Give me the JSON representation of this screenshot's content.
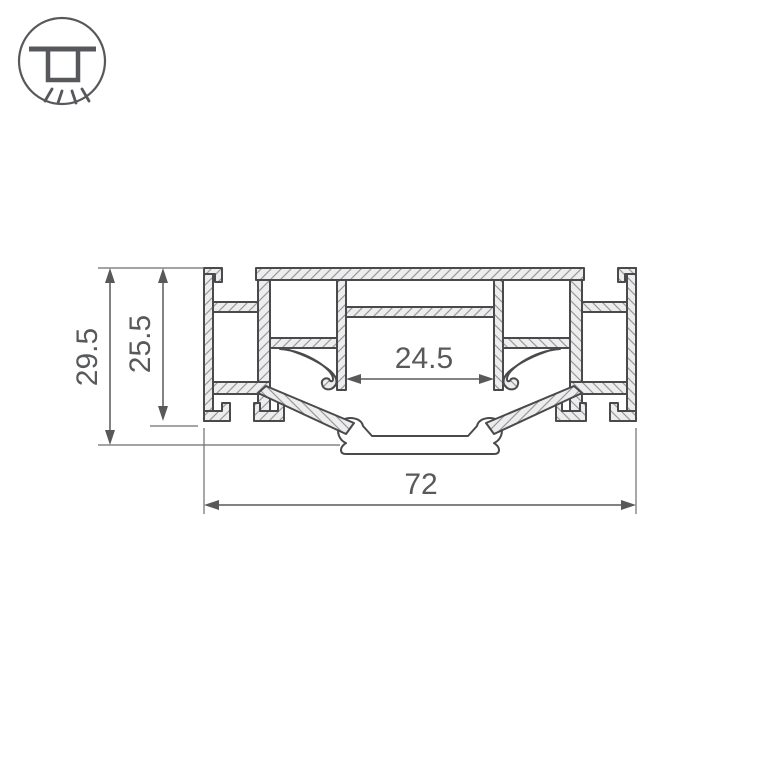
{
  "icon": {
    "name": "recessed-ceiling-light",
    "description": "circle badge with surface-mounted downlight and light rays"
  },
  "drawing": {
    "type": "technical-cross-section",
    "subject": "aluminum-led-profile",
    "dimensions": {
      "overall_height": "29.5",
      "body_height": "25.5",
      "inner_width": "24.5",
      "overall_width": "72"
    },
    "colors": {
      "outline": "#4a4a4c",
      "hatch": "#98999b",
      "material": "#ededee",
      "dimension": "#58595b",
      "icon": "#57585c",
      "background": "#ffffff"
    }
  }
}
